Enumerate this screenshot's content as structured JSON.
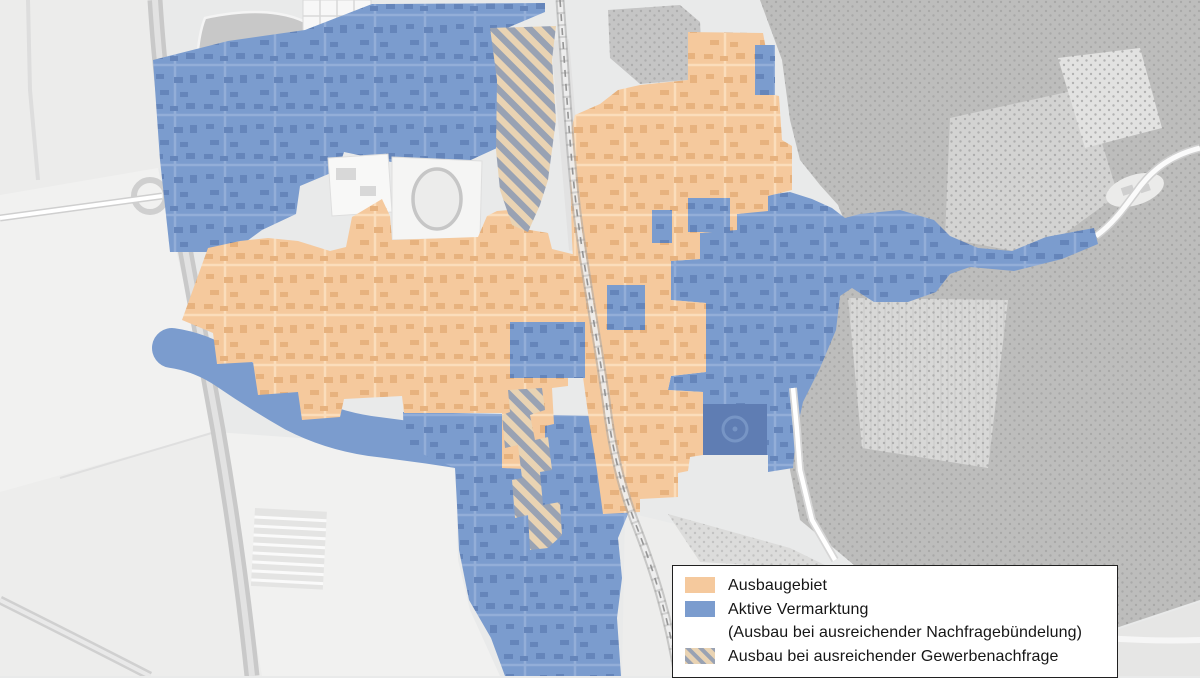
{
  "legend": {
    "items": [
      {
        "label": "Ausbaugebiet"
      },
      {
        "label": "Aktive Vermarktung",
        "sublabel": "(Ausbau bei ausreichender Nachfragebündelung)"
      },
      {
        "label": "Ausbau bei ausreichender Gewerbenachfrage"
      }
    ]
  },
  "colors": {
    "expansion": "#f5c99d",
    "expansion_buildings": "#e7b27e",
    "expansion_streets": "#fbddbb",
    "marketing": "#7b9cce",
    "marketing_buildings": "#6585ba",
    "marketing_streets": "#93aed8",
    "marketing_dark": "#5f7db3",
    "hatch_base": "#e9d3b3",
    "hatch_stripe": "#99a2b3",
    "base_map": "#e9eaea",
    "forest": "#bdbdbc",
    "legend_background": "#ffffff",
    "legend_border": "#202020",
    "legend_text": "#161616"
  }
}
